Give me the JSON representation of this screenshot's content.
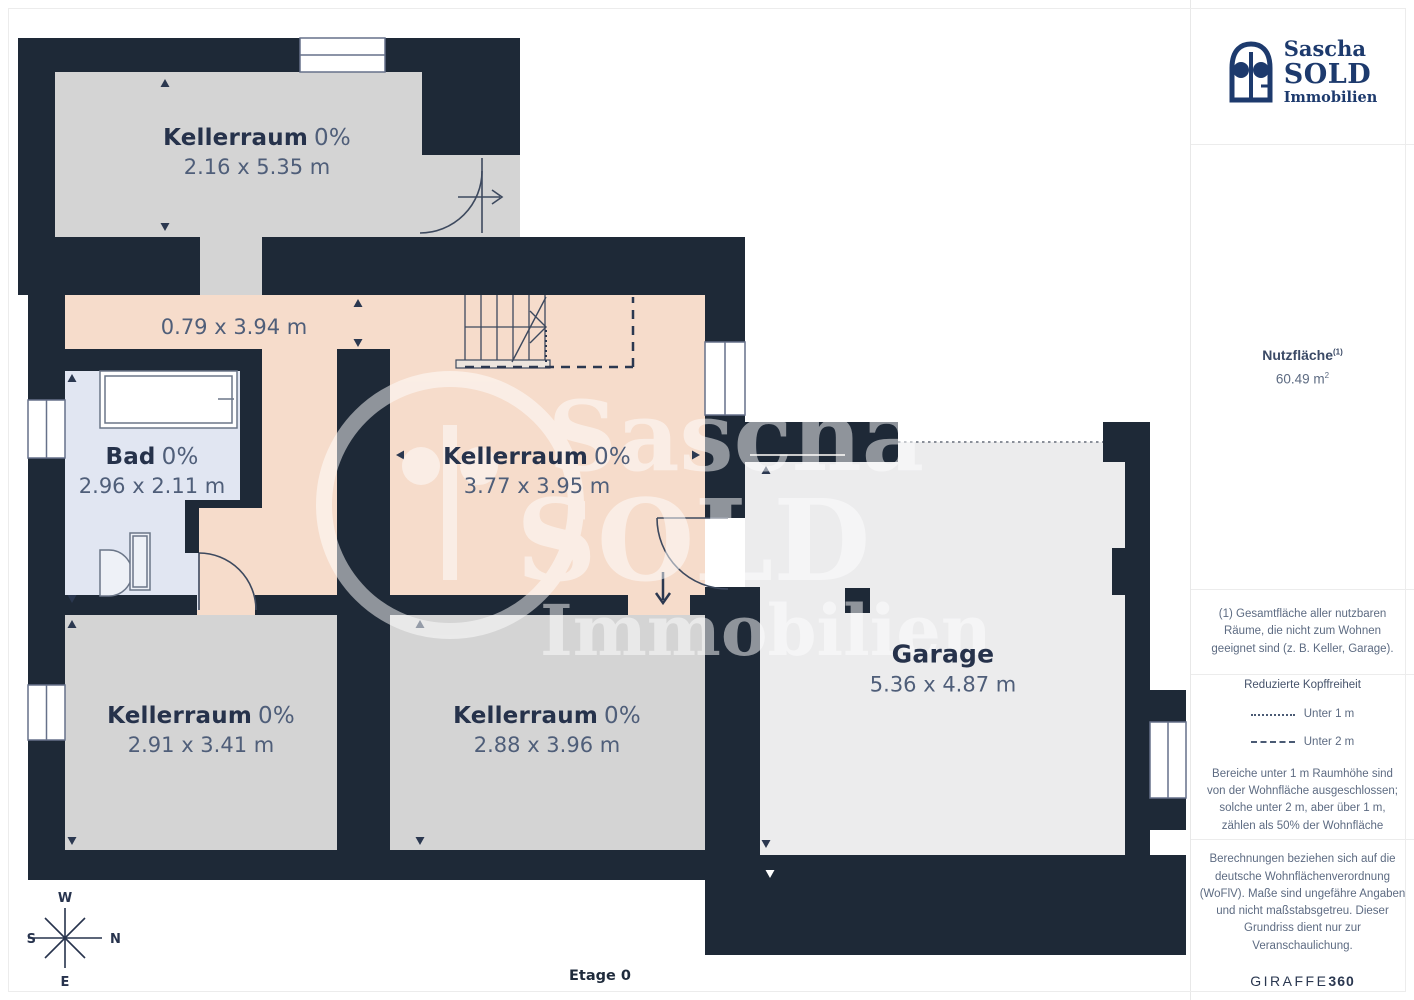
{
  "palette": {
    "wall": "#1e2937",
    "room_gray": "#d4d4d4",
    "room_peach": "#f6dccb",
    "room_blue": "#e1e6f2",
    "room_garage": "#ececed",
    "brand_blue": "#1d3a6d",
    "label_dark": "#26324b",
    "label_muted": "#4f5e79"
  },
  "plan": {
    "rooms": {
      "keller_top": {
        "name": "Kellerraum",
        "percent": "0%",
        "dims": "2.16 x 5.35 m"
      },
      "flur": {
        "dims": "0.79 x 3.94 m"
      },
      "bad": {
        "name": "Bad",
        "percent": "0%",
        "dims": "2.96 x 2.11 m"
      },
      "keller_mitte": {
        "name": "Kellerraum",
        "percent": "0%",
        "dims": "3.77 x 3.95 m"
      },
      "keller_links": {
        "name": "Kellerraum",
        "percent": "0%",
        "dims": "2.91 x 3.41 m"
      },
      "keller_unten": {
        "name": "Kellerraum",
        "percent": "0%",
        "dims": "2.88 x 3.96 m"
      },
      "garage": {
        "name": "Garage",
        "dims": "5.36 x 4.87 m"
      }
    },
    "compass": {
      "north": "N",
      "south": "S",
      "east": "E",
      "west": "W"
    },
    "floor_label": "Etage 0",
    "watermark": {
      "line1": "Sascha",
      "line2": "SOLD",
      "line3": "Immobilien"
    }
  },
  "sidebar": {
    "logo": {
      "line1": "Sascha",
      "line2": "SOLD",
      "line3": "Immobilien"
    },
    "area": {
      "label": "Nutzfläche",
      "marker": "(1)",
      "value": "60.49 m",
      "value_sup": "2"
    },
    "footnote_lines": [
      "(1) Gesamtfläche aller nutzbaren",
      "Räume, die nicht zum Wohnen",
      "geeignet sind (z. B. Keller, Garage)."
    ],
    "legend": {
      "title": "Reduzierte Kopffreiheit",
      "item1": "Unter 1 m",
      "item2": "Unter 2 m",
      "note_lines": [
        "Bereiche unter 1 m Raumhöhe sind",
        "von der Wohnfläche ausgeschlossen;",
        "solche unter 2 m, aber über 1 m,",
        "zählen als 50% der Wohnfläche"
      ]
    },
    "disclaimer_lines": [
      "Berechnungen beziehen sich auf die",
      "deutsche Wohnflächenverordnung",
      "(WoFlV). Maße sind ungefähre Angaben",
      "und nicht maßstabsgetreu. Dieser",
      "Grundriss dient nur zur",
      "Veranschaulichung."
    ],
    "brand": {
      "name": "GIRAFFE",
      "suffix": "360"
    }
  }
}
